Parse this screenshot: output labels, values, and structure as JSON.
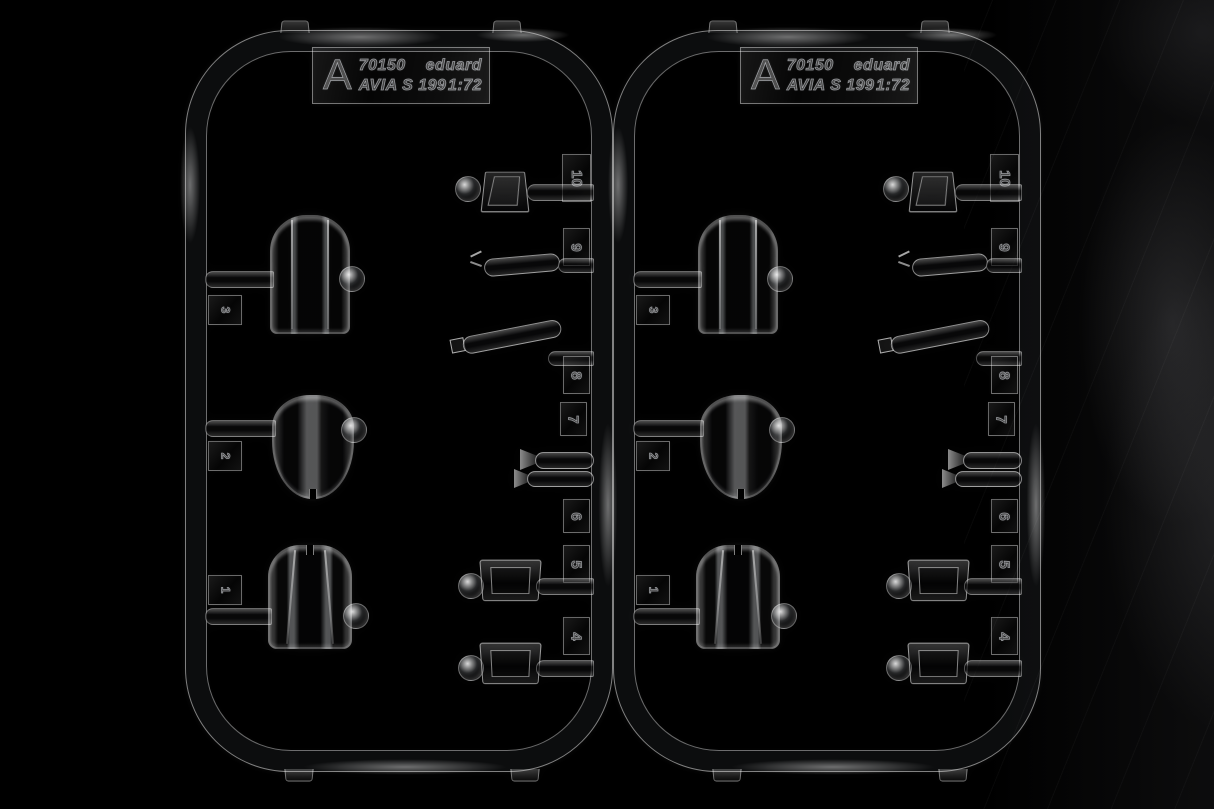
{
  "scene": {
    "background_color": "#000000",
    "surface_sheen_color": "#3c3c3e",
    "plastic_highlight_color": "#ffffff"
  },
  "sprues": [
    {
      "side": "left",
      "label": {
        "letter": "A",
        "kit_number": "70150",
        "brand": "eduard",
        "subject": "AVIA S 199",
        "scale": "1:72"
      },
      "canopy_parts": [
        {
          "number": "3"
        },
        {
          "number": "2"
        },
        {
          "number": "1"
        }
      ],
      "small_parts": [
        {
          "number": "10"
        },
        {
          "number": "9"
        },
        {
          "number": "8"
        },
        {
          "number": "7"
        },
        {
          "number": "6"
        },
        {
          "number": "5"
        },
        {
          "number": "4"
        }
      ]
    },
    {
      "side": "right",
      "label": {
        "letter": "A",
        "kit_number": "70150",
        "brand": "eduard",
        "subject": "AVIA S 199",
        "scale": "1:72"
      },
      "canopy_parts": [
        {
          "number": "3"
        },
        {
          "number": "2"
        },
        {
          "number": "1"
        }
      ],
      "small_parts": [
        {
          "number": "10"
        },
        {
          "number": "9"
        },
        {
          "number": "8"
        },
        {
          "number": "7"
        },
        {
          "number": "6"
        },
        {
          "number": "5"
        },
        {
          "number": "4"
        }
      ]
    }
  ]
}
